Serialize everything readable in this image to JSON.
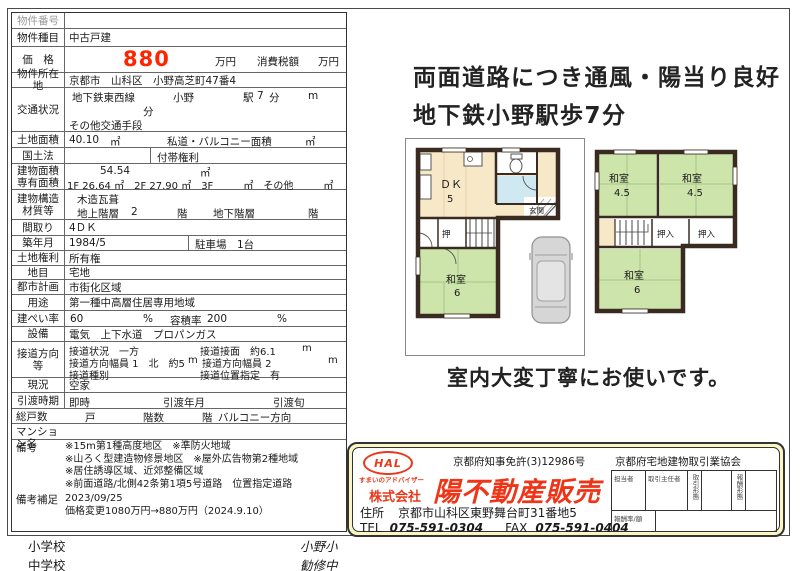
{
  "t": {
    "bango_l": "物件番号",
    "shumoku_l": "物件種目",
    "shumoku_v": "中古戸建",
    "kakaku_l": "価　格",
    "price": "880",
    "price_unit": "万円",
    "tax_l": "消費税額",
    "tax_unit": "万円",
    "addr_l": "物件所在地",
    "addr_v": "京都市　山科区　小野高芝町47番4",
    "kotsu_l": "交通状況",
    "line_v": "地下鉄東西線",
    "sta_v": "小野",
    "eki": "駅",
    "min_v": "7",
    "min_u": "分",
    "m_u": "m",
    "kotsu2": "分",
    "kotsu3": "その他交通手段",
    "tochi_l": "土地面積",
    "tochi_v": "40.10",
    "sqm": "㎡",
    "shido_l": "私道・バルコニー面積",
    "shido_u": "㎡",
    "kokudo_l": "国土法",
    "futai_l": "付帯権利",
    "tate_l": "建物面積",
    "tate_v": "54.54",
    "tate_u": "㎡",
    "senyu_l": "専有面積",
    "senyu_v": "1F 26.64 ㎡　2F 27.90 ㎡　3F　　　㎡　その他　　　㎡",
    "kozo_l1": "建物構造",
    "kozo_l2": "材質等",
    "kozo_v": "木造瓦葺",
    "chijo_l": "地上階層",
    "chijo_v": "2",
    "kai1": "階",
    "chika_l": "地下階層",
    "kai2": "階",
    "madori_l": "間取り",
    "madori_v": "4ＤＫ",
    "chiku_l": "築年月",
    "chiku_v": "1984/5",
    "park_l": "駐車場",
    "park_v": "1台",
    "kenri_l": "土地権利",
    "kenri_v": "所有権",
    "chimoku_l": "地目",
    "chimoku_v": "宅地",
    "toshi_l": "都市計画",
    "toshi_v": "市街化区域",
    "yoto_l": "用途",
    "yoto_v": "第一種中高層住居専用地域",
    "kenpei_l": "建ぺい率",
    "kenpei_v": "60",
    "pct1": "%",
    "yoseki_l": "容積率",
    "yoseki_v": "200",
    "pct2": "%",
    "setsubi_l": "設備",
    "setsubi_v": "電気　上下水道　プロパンガス",
    "setsudo_l": "接道方向等",
    "sd1a": "接道状況　一方",
    "sd1b": "接道接面　約6.1",
    "sd1c": "m",
    "sd2a": "接道方向幅員 1　北　約5",
    "sd2b": "m",
    "sd2c": "接道方向幅員 2",
    "sd2d": "m",
    "sd3a": "接道種別",
    "sd3b": "接道位置指定　有",
    "genkyo_l": "現況",
    "genkyo_v": "空家",
    "hiki_l": "引渡時期",
    "hiki_v": "即時",
    "hiki_nen": "引渡年月",
    "hiki_jun": "引渡旬",
    "kosu_l": "総戸数",
    "ko": "戸",
    "kaisu": "階数",
    "kai3": "階",
    "balc": "バルコニー方向",
    "mansion_l": "マンション名",
    "biko_l": "備考",
    "biko1": "※15m第1種高度地区　※準防火地域",
    "biko2": "※山ろく型建造物修景地区　※屋外広告物第2種地域",
    "biko3": "※居住誘導区域、近郊整備区域",
    "biko4": "※前面道路/北側42条第1項5号道路　位置指定道路",
    "hosoku_l": "備考補足",
    "hosoku1": "2023/09/25",
    "hosoku2": "価格変更1080万円→880万円（2024.9.10）"
  },
  "schools": {
    "e_l": "小学校",
    "e_v": "小野小",
    "j_l": "中学校",
    "j_v": "勧修中"
  },
  "right": {
    "headline1": "両面道路につき通風・陽当り良好",
    "headline2": "地下鉄小野駅歩7分",
    "caption": "室内大変丁寧にお使いです。"
  },
  "plan1": {
    "dk": "ＤＫ",
    "dk_n": "5",
    "genkan": "玄関",
    "oshi": "押",
    "washitsu": "和室",
    "washitsu_n": "6"
  },
  "plan2": {
    "w1": "和室",
    "w1n": "4.5",
    "w2": "和室",
    "w2n": "4.5",
    "o1": "押入",
    "o2": "押入",
    "w3": "和室",
    "w3n": "6"
  },
  "company": {
    "logo": "HAL",
    "logo_sub": "すまいのアドバイザー",
    "license": "京都府知事免許(3)12986号",
    "assoc": "京都府宅地建物取引業協会",
    "prefix": "株式会社",
    "name": "陽不動産販売",
    "addr_l": "住所",
    "addr": "京都市山科区東野舞台町31番地5",
    "tel_l": "TEL",
    "tel": "075-591-0304",
    "fax_l": "FAX",
    "fax": "075-591-0404",
    "mt_tanto": "担当者",
    "mt_shunin": "取引主任者",
    "mt_keitai": "取引形態",
    "mt_hoshu": "報酬形態",
    "mt_ritsu": "報酬率/額"
  },
  "colors": {
    "price_red": "#ff2400",
    "brand_red": "#e8391c",
    "tatami_green": "#cde4ab",
    "floor_cream": "#f7e8c7",
    "bath_blue": "#cfe8f1",
    "wall_dark": "#3a2b22",
    "box_yellow": "#faf6c3",
    "car_grey": "#d6d6d6"
  }
}
